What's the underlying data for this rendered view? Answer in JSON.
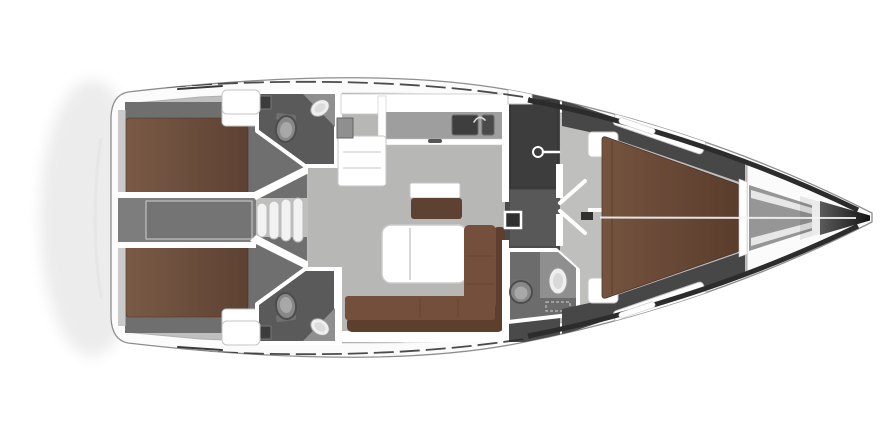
{
  "canvas": {
    "width": 890,
    "height": 446
  },
  "diagram": {
    "kind": "sailing-yacht-interior-floor-plan",
    "orientation": "bow-right-stern-left",
    "rooms": [
      {
        "id": "aft-cabin-port",
        "furniture": [
          "double-bed",
          "locker"
        ]
      },
      {
        "id": "aft-cabin-starboard",
        "furniture": [
          "double-bed",
          "locker"
        ]
      },
      {
        "id": "engine-compartment",
        "furniture": [
          "engine-box"
        ]
      },
      {
        "id": "companionway",
        "furniture": [
          "steps"
        ]
      },
      {
        "id": "aft-head-port",
        "furniture": [
          "toilet",
          "washbasin",
          "shower-mixer"
        ]
      },
      {
        "id": "aft-head-starboard",
        "furniture": [
          "toilet",
          "washbasin",
          "shower-mixer"
        ]
      },
      {
        "id": "saloon",
        "furniture": [
          "l-shaped-sofa",
          "folding-table",
          "bench-seat",
          "shelf"
        ]
      },
      {
        "id": "galley",
        "furniture": [
          "counter",
          "double-sink"
        ]
      },
      {
        "id": "corridor",
        "furniture": [
          "hanging-locker",
          "electrical-panel",
          "cabin-door-open"
        ]
      },
      {
        "id": "forward-head",
        "furniture": [
          "toilet",
          "washbasin",
          "vanity-counter"
        ]
      },
      {
        "id": "forward-cabin",
        "furniture": [
          "v-berth-double-bed",
          "side-shelves",
          "entry-seats"
        ]
      },
      {
        "id": "anchor-locker",
        "furniture": []
      }
    ]
  },
  "colors": {
    "background": "#ffffff",
    "hull_fill": "#fbfbfb",
    "hull_stroke": "#8e8e8e",
    "deck_shadow": "#e3e3e3",
    "stern_glow": "#ececec",
    "toe_rail": "#2c2c2c",
    "interior_base": "#bfc0be",
    "salon_floor": "#b7b8b6",
    "cabin_floor": "#6f6f6f",
    "corridor_floor": "#7d7d7d",
    "engine_box": "#747474",
    "dark_zone": "#4a4a4a",
    "fwd_dark": "#474747",
    "wardrobe": "#3d3d3d",
    "corridor_mid": "#585858",
    "wet_floor": "#5a5a5a",
    "wet_floor_fwd": "#6c6c6c",
    "counter": "#9e9e9e",
    "counter_light": "#8f8f8f",
    "wall": "#ffffff",
    "wall_stroke": "#c6c6c6",
    "fixture_light": "#efefef",
    "fixture_stroke": "#9a9a9a",
    "toilet": "#888888",
    "toilet_dark": "#4d4d4d",
    "toilet_inner": "#a8a8a8",
    "sink_steel": "#3e3e3e",
    "steel_dark": "#6b6b6b",
    "panel_dark": "#303030",
    "bed_light": "#7a5a46",
    "bed_dark": "#5d4132",
    "fwd_bed_light": "#75543f",
    "fwd_bed_dark": "#5a3c2c",
    "sofa": "#74503c",
    "sofa_dark": "#5e3f2d",
    "bench": "#5e4231",
    "table": "#ffffff",
    "table_stroke": "#cbcbcb",
    "anchor_locker": "#969696",
    "bow_mid": "#5a5a5a",
    "bow_tip": "#141414",
    "centerline": "#f4f4f4",
    "handrail": "#3a3a3a",
    "stern_locker": "#b5b5b5",
    "swim_arc": "#e6e6e6",
    "step_fill": "#f2f2f2",
    "step_stroke": "#bbbbbb",
    "shower_box": "#3c3c3c"
  }
}
